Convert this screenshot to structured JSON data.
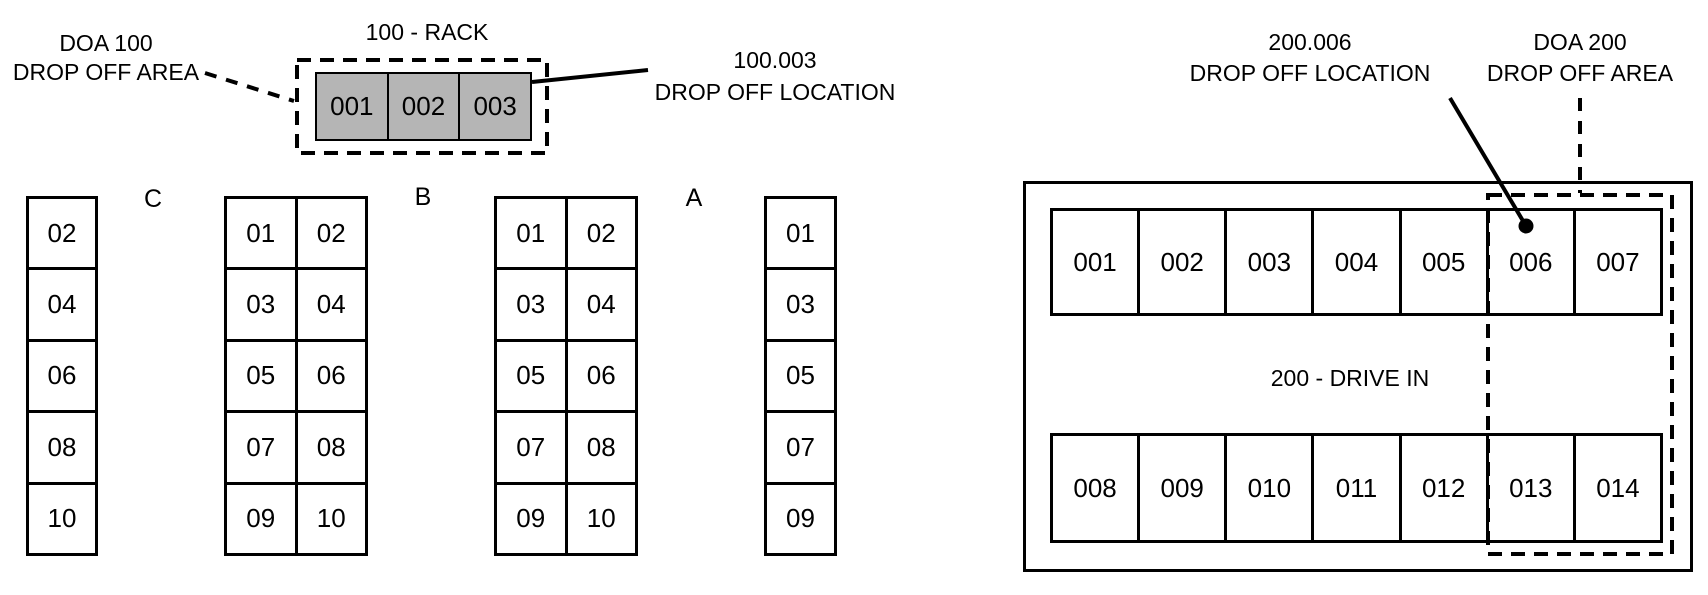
{
  "colors": {
    "rack_fill": "#b5b5b5",
    "line": "#000000",
    "background": "#ffffff"
  },
  "rack_100": {
    "title": "100 - RACK",
    "doa_label": {
      "line1": "DOA 100",
      "line2": "DROP OFF AREA"
    },
    "location_label": {
      "line1": "100.003",
      "line2": "DROP OFF LOCATION"
    },
    "cells": [
      "001",
      "002",
      "003"
    ]
  },
  "storage_columns": {
    "aisle_labels": [
      "C",
      "B",
      "A"
    ],
    "columns": [
      {
        "cells": [
          "02",
          "04",
          "06",
          "08",
          "10"
        ]
      },
      {
        "cells": [
          "01",
          "02",
          "03",
          "04",
          "05",
          "06",
          "07",
          "08",
          "09",
          "10"
        ]
      },
      {
        "cells": [
          "01",
          "02",
          "03",
          "04",
          "05",
          "06",
          "07",
          "08",
          "09",
          "10"
        ]
      },
      {
        "cells": [
          "01",
          "03",
          "05",
          "07",
          "09"
        ]
      }
    ]
  },
  "drive_in_200": {
    "title": "200 - DRIVE IN",
    "location_label": {
      "line1": "200.006",
      "line2": "DROP OFF LOCATION"
    },
    "doa_label": {
      "line1": "DOA 200",
      "line2": "DROP OFF AREA"
    },
    "top_row": [
      "001",
      "002",
      "003",
      "004",
      "005",
      "006",
      "007"
    ],
    "bottom_row": [
      "008",
      "009",
      "010",
      "011",
      "012",
      "013",
      "014"
    ]
  }
}
